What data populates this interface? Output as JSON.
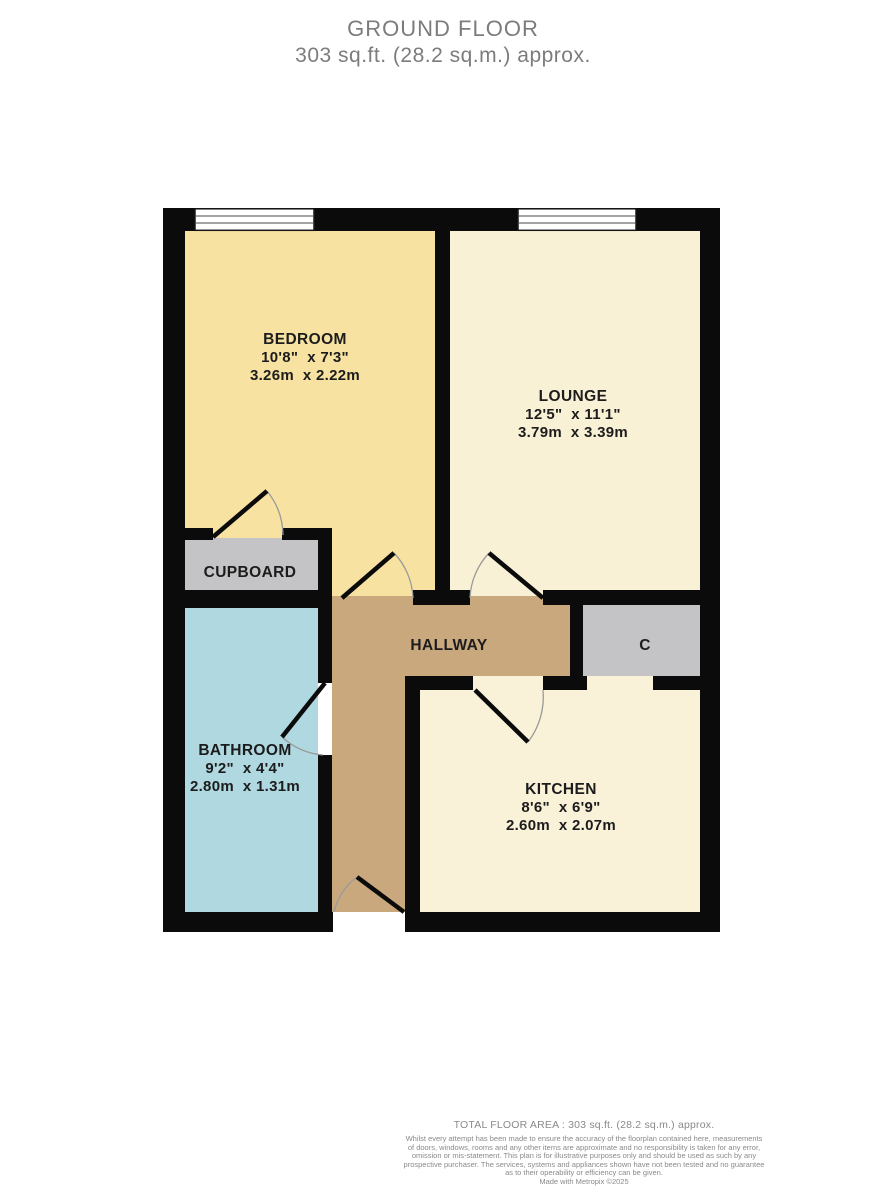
{
  "header": {
    "title": "GROUND FLOOR",
    "subtitle": "303 sq.ft. (28.2 sq.m.) approx."
  },
  "rooms": {
    "bedroom": {
      "name": "BEDROOM",
      "imperial": "10'8\"  x 7'3\"",
      "metric": "3.26m  x 2.22m"
    },
    "lounge": {
      "name": "LOUNGE",
      "imperial": "12'5\"  x 11'1\"",
      "metric": "3.79m  x 3.39m"
    },
    "cupboard": {
      "name": "CUPBOARD"
    },
    "hallway": {
      "name": "HALLWAY"
    },
    "storage_c": {
      "name": "C"
    },
    "bathroom": {
      "name": "BATHROOM",
      "imperial": "9'2\"  x 4'4\"",
      "metric": "2.80m  x 1.31m"
    },
    "kitchen": {
      "name": "KITCHEN",
      "imperial": "8'6\"  x 6'9\"",
      "metric": "2.60m  x 2.07m"
    }
  },
  "footer": {
    "total": "TOTAL FLOOR AREA : 303 sq.ft. (28.2 sq.m.) approx.",
    "disclaimer_lines": [
      "Whilst every attempt has been made to ensure the accuracy of the floorplan contained here, measurements",
      "of doors, windows, rooms and any other items are approximate and no responsibility is taken for any error,",
      "omission or mis-statement. This plan is for illustrative purposes only and should be used as such by any",
      "prospective purchaser. The services, systems and appliances shown have not been tested and no guarantee",
      "as to their operability or efficiency can be given."
    ],
    "credit": "Made with Metropix ©2025"
  },
  "colors": {
    "wall": "#0b0b0b",
    "bedroom": "#f7e2a2",
    "lounge": "#f9f1d6",
    "kitchen": "#f9f2d9",
    "bathroom": "#afd8e0",
    "hallway": "#c9a87e",
    "storage_grey": "#c4c4c6",
    "label_text": "#1c1c1c",
    "header_text": "#7c7c7c",
    "footer_text": "#8a8a8a"
  }
}
